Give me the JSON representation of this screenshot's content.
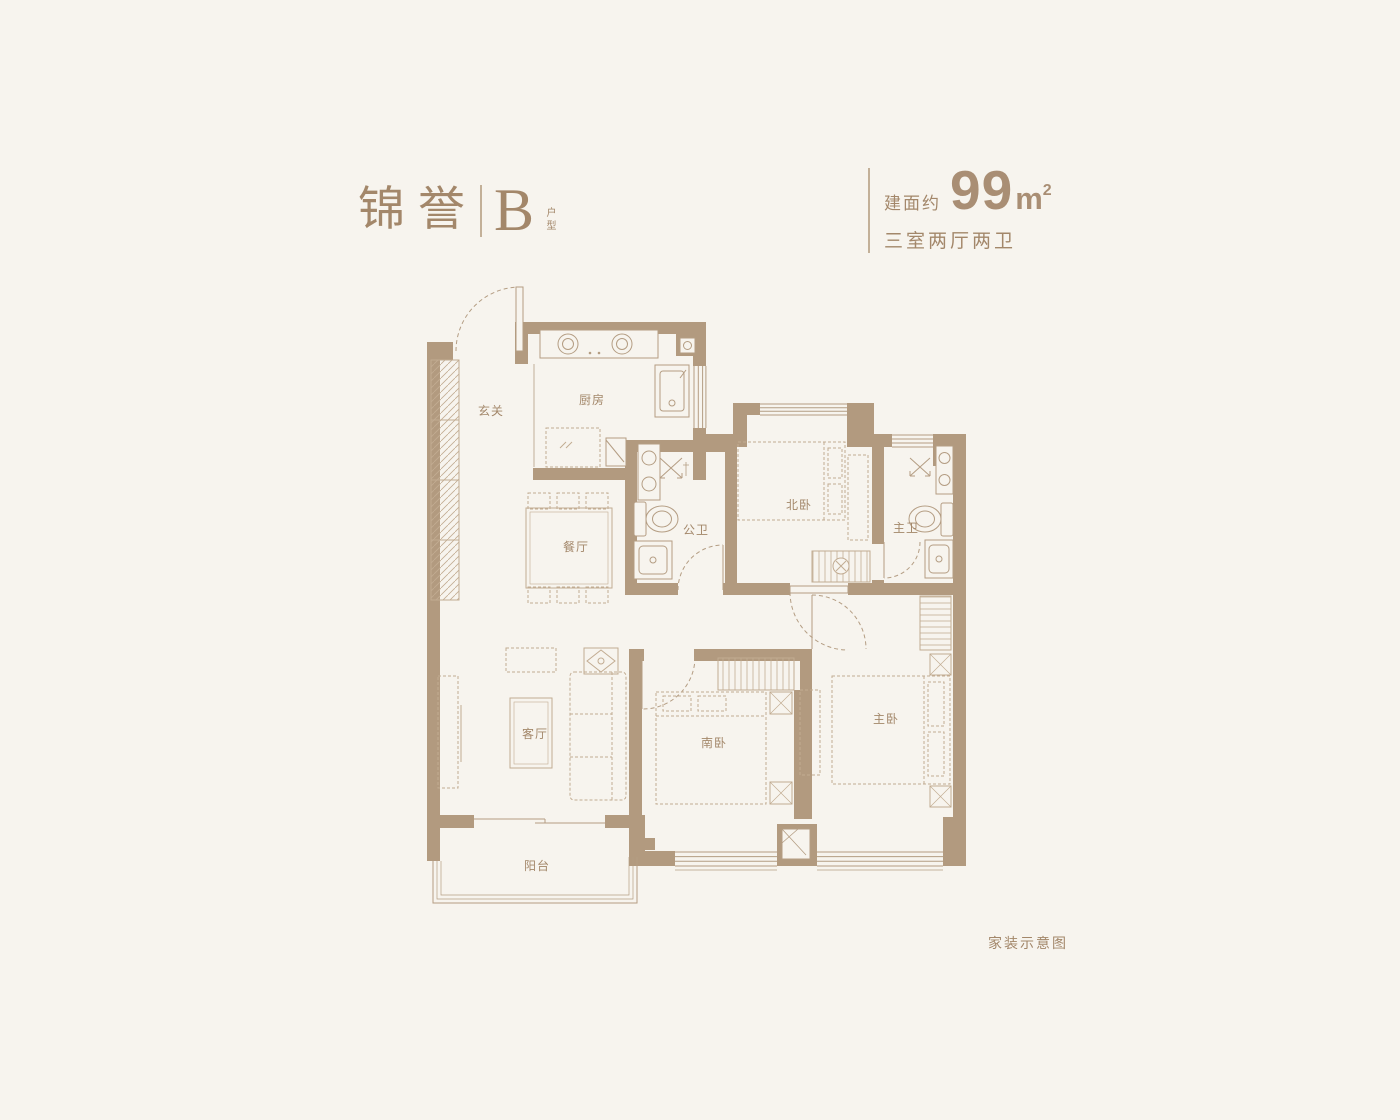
{
  "header": {
    "project_name": "锦誉",
    "unit_code": "B",
    "unit_code_suffix": "户型",
    "area_label": "建面约",
    "area_value": "99",
    "area_unit_base": "m",
    "area_unit_exponent": "2",
    "layout_summary": "三室两厅两卫"
  },
  "plan": {
    "rooms": {
      "entry": "玄关",
      "kitchen": "厨房",
      "dining": "餐厅",
      "public_bath": "公卫",
      "north_bedroom": "北卧",
      "master_bath": "主卫",
      "living": "客厅",
      "south_bedroom": "南卧",
      "master_bedroom": "主卧",
      "balcony": "阳台"
    }
  },
  "footer": {
    "note": "家装示意图"
  },
  "colors": {
    "wall": "#b29a7f",
    "accent_text": "#a3876a",
    "line": "#b49d83",
    "furniture": "#c2ac92",
    "background": "#f7f4ee"
  }
}
